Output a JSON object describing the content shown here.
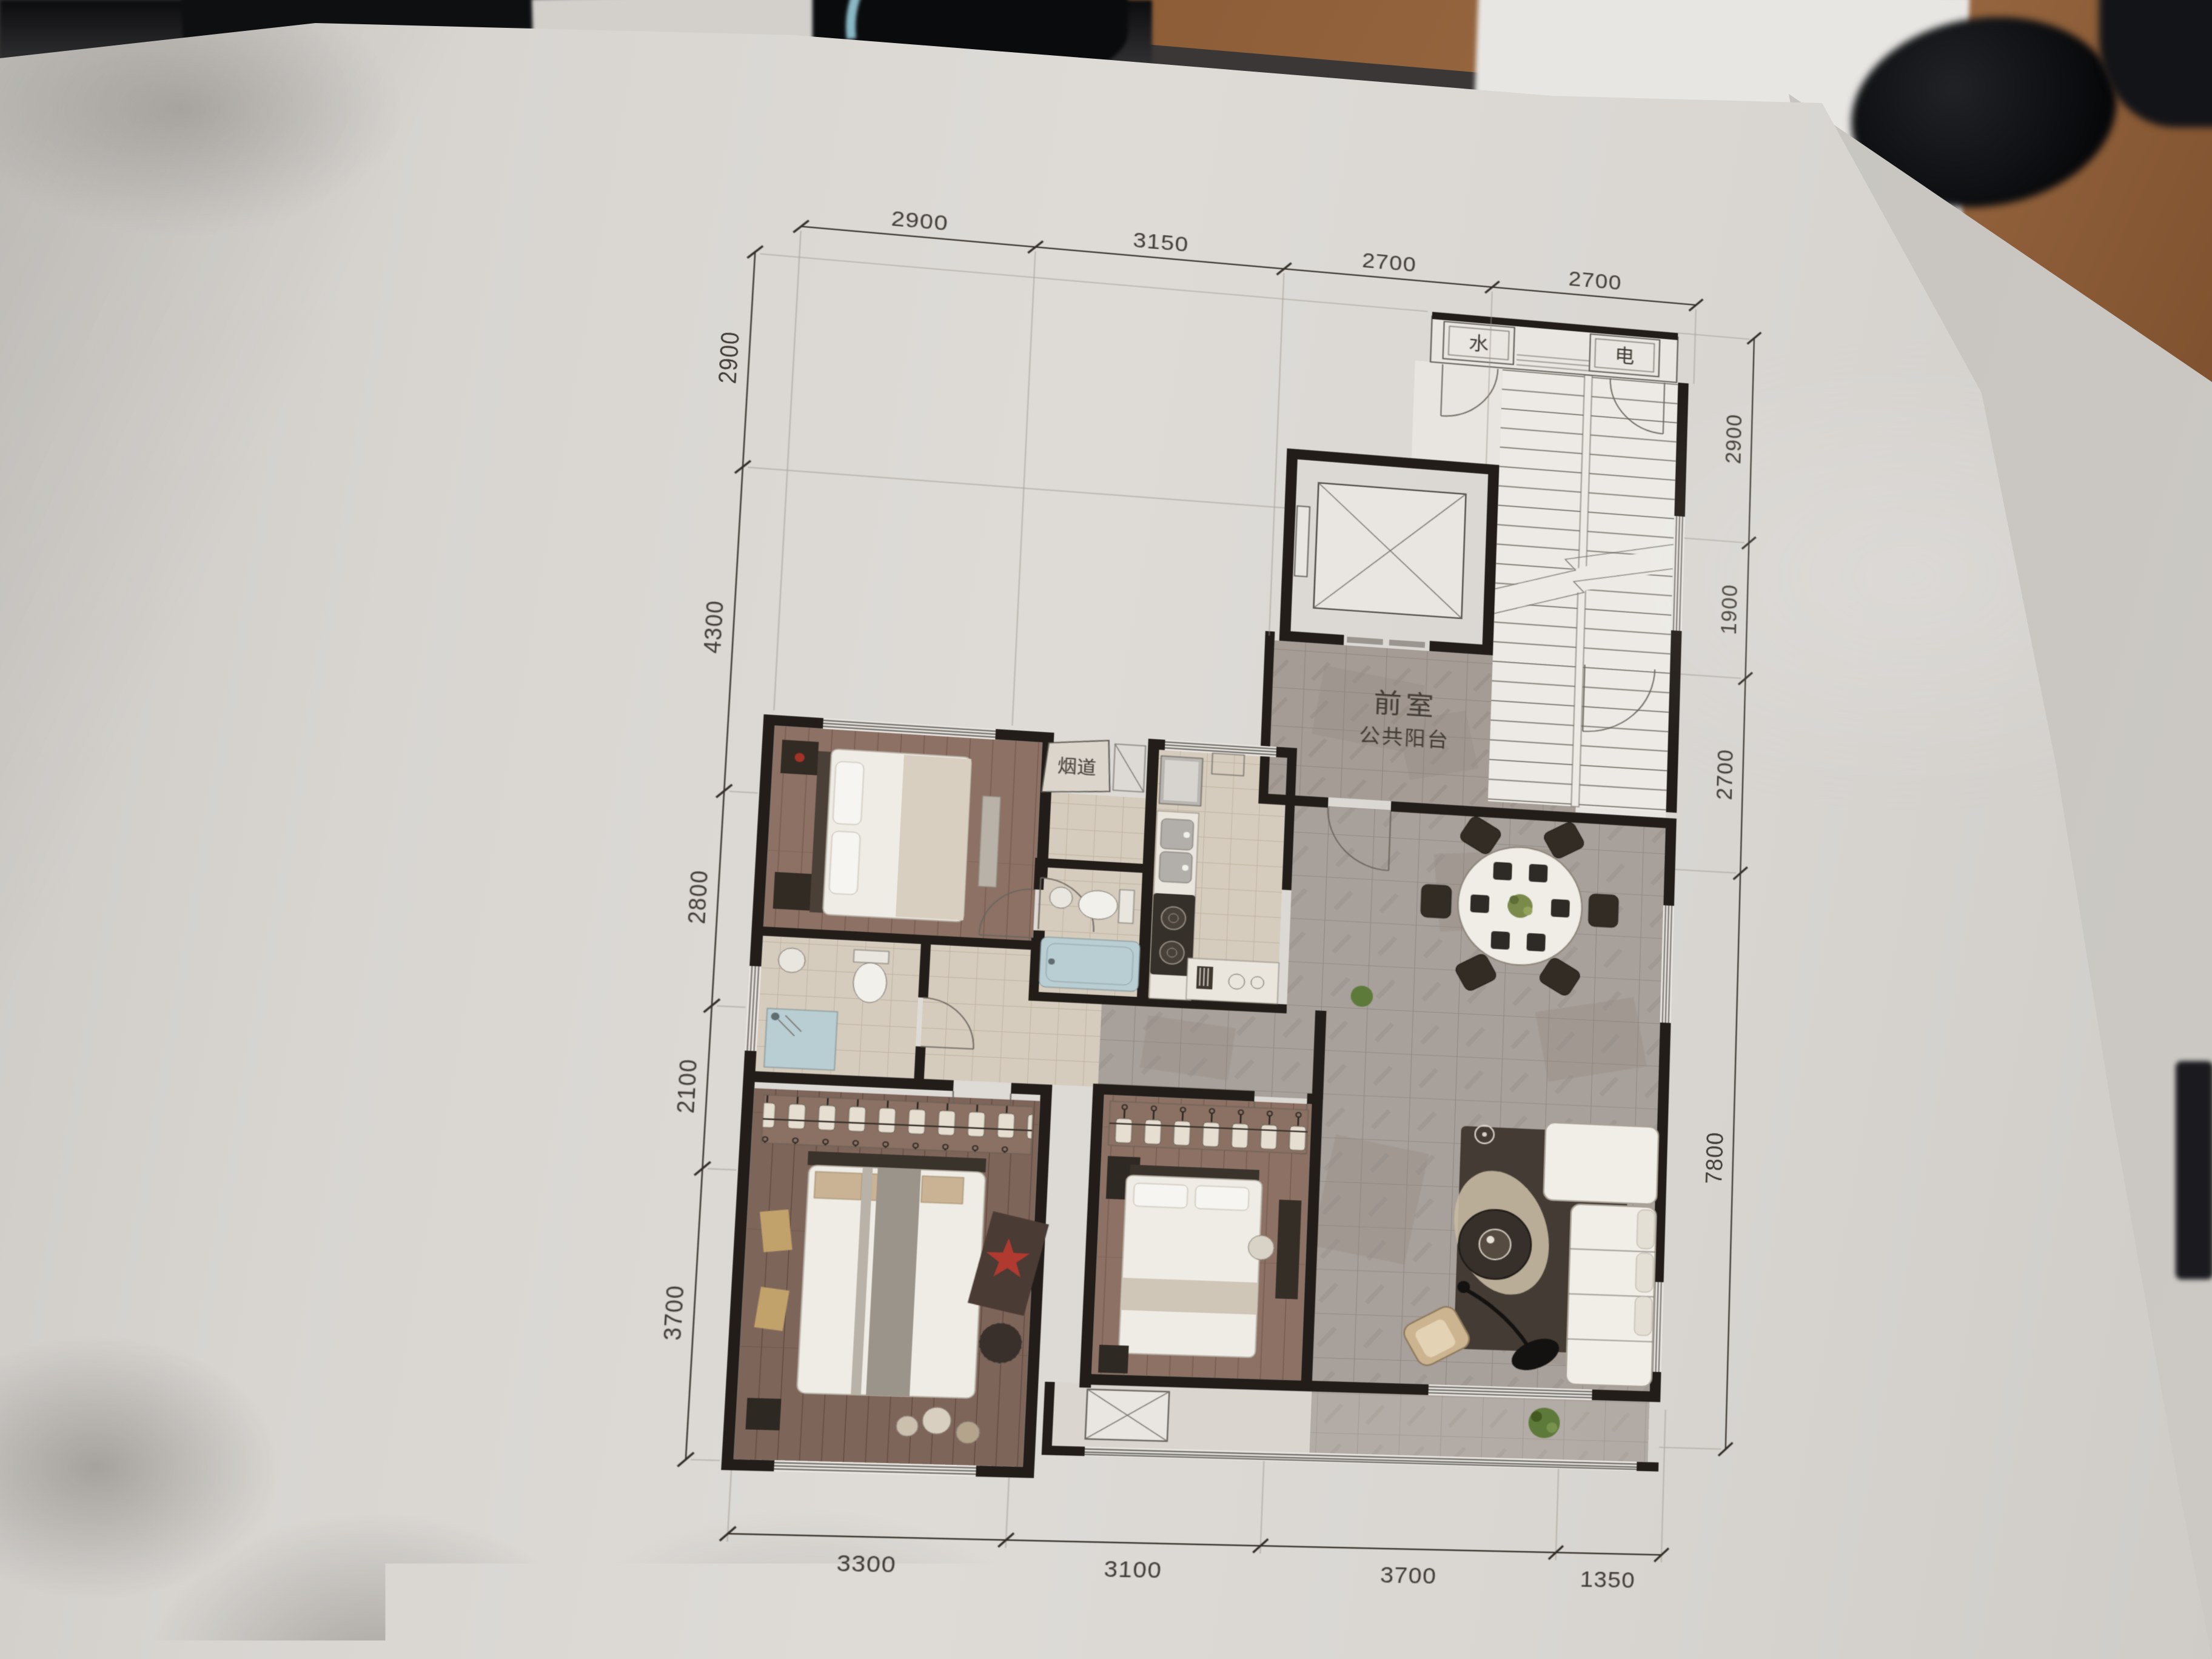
{
  "photo": {
    "watermark": "bbs.dzsm.com",
    "disclaimer_visible": "业态规划仅为目前规划状态，存在不确定因素，最终呈现结果",
    "colors": {
      "paper": "#d8d5d1",
      "desk_wood": "#8a5a36",
      "cable_accent": "#8ab8c5",
      "watermark_color": "#f3f1ed"
    }
  },
  "plan": {
    "labels": {
      "front_room": "前室",
      "public_balcony": "公共阳台",
      "flue": "烟道",
      "water": "水",
      "electric": "电"
    },
    "dims": {
      "top": [
        "2900",
        "3150",
        "2700",
        "2700"
      ],
      "bottom": [
        "3300",
        "3100",
        "3700",
        "1350"
      ],
      "left": [
        "2900",
        "4300",
        "2800",
        "2100",
        "3700"
      ],
      "right": [
        "2900",
        "1900",
        "2700",
        "7800"
      ]
    },
    "colors": {
      "wall": "#221d18",
      "wood_floor": "#8c7164",
      "beige_tile": "#d6ccbd",
      "grey_marble": "#a8a09a",
      "hall_tile": "#a59c95",
      "fixture_white": "#efece6",
      "tub_blue": "#b9ced2"
    }
  }
}
